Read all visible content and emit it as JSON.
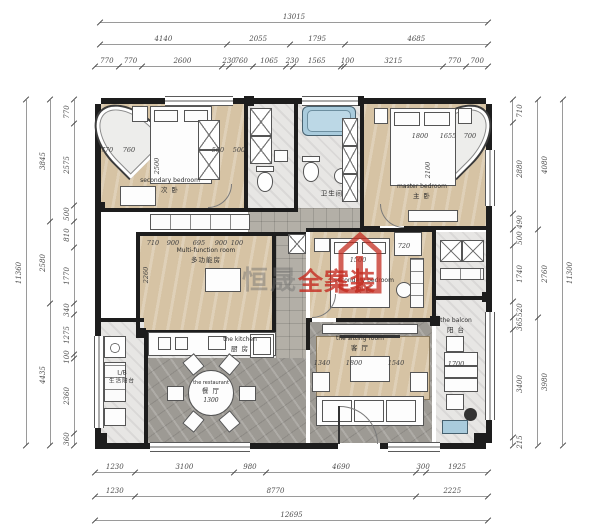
{
  "watermark": {
    "gray_text": "恒晟",
    "red_text": "全案装",
    "red_color": "#c42c20"
  },
  "rooms": {
    "secondary_bedroom": {
      "en": "secondary bedroom",
      "zh": "次 卧"
    },
    "master_bedroom": {
      "en": "master bedroom",
      "zh": "主 卧"
    },
    "multi_function_room": {
      "en": "Multi-function room",
      "zh": "多功能房"
    },
    "secondary_bedroom_2": {
      "en": "secondary bedroom",
      "zh": "次 卧"
    },
    "bathroom": {
      "en": "washroom",
      "zh": "卫生间"
    },
    "kitchen": {
      "en": "the kitchen",
      "zh": "厨 房"
    },
    "restaurant": {
      "en": "the restaurant",
      "zh": "餐 厅",
      "table_dim": "1300"
    },
    "sitting_room": {
      "en": "the sitting room",
      "zh": "客 厅"
    },
    "life_balcony": {
      "en": "L/B",
      "zh": "生活阳台"
    },
    "leisure_balcony": {
      "en": "the balcon",
      "zh": "阳 台"
    }
  },
  "dimensions": {
    "top": {
      "row1": [
        "13015"
      ],
      "row2": [
        "4140",
        "2055",
        "1795",
        "4685"
      ],
      "row3": [
        "770",
        "770",
        "2600",
        "230",
        "760",
        "1065",
        "230",
        "1565",
        "100",
        "3215",
        "770",
        "700"
      ]
    },
    "bottom": {
      "row1": [
        "1230",
        "3100",
        "980",
        "4690",
        "300",
        "1925"
      ],
      "row2": [
        "1230",
        "8770",
        "2225"
      ],
      "row3": [
        "12695"
      ]
    },
    "left": {
      "outer": [
        "11360"
      ],
      "middle": [
        "3845",
        "2580",
        "4435"
      ],
      "inner": [
        "770",
        "2575",
        "500",
        "810",
        "1770",
        "340",
        "1275",
        "100",
        "2360",
        "360"
      ]
    },
    "right": {
      "inner": [
        "710",
        "2880",
        "490",
        "500",
        "1740",
        "520",
        "365",
        "3400",
        "215"
      ],
      "middle": [
        "4080",
        "2760",
        "3980"
      ],
      "outer": [
        "11300"
      ]
    }
  },
  "annotations": [
    {
      "t": "770",
      "x": 107,
      "y": 150
    },
    {
      "t": "760",
      "x": 129,
      "y": 150
    },
    {
      "t": "560",
      "x": 218,
      "y": 150
    },
    {
      "t": "500",
      "x": 239,
      "y": 150
    },
    {
      "t": "2500",
      "x": 157,
      "y": 166,
      "v": 1
    },
    {
      "t": "1800",
      "x": 420,
      "y": 136
    },
    {
      "t": "2100",
      "x": 428,
      "y": 170,
      "v": 1
    },
    {
      "t": "1655",
      "x": 448,
      "y": 136
    },
    {
      "t": "700",
      "x": 470,
      "y": 136
    },
    {
      "t": "710",
      "x": 153,
      "y": 243
    },
    {
      "t": "900",
      "x": 173,
      "y": 243
    },
    {
      "t": "695",
      "x": 199,
      "y": 243
    },
    {
      "t": "900",
      "x": 221,
      "y": 243
    },
    {
      "t": "100",
      "x": 237,
      "y": 243
    },
    {
      "t": "2260",
      "x": 146,
      "y": 275,
      "v": 1
    },
    {
      "t": "1500",
      "x": 358,
      "y": 260
    },
    {
      "t": "720",
      "x": 404,
      "y": 246
    },
    {
      "t": "1340",
      "x": 322,
      "y": 363
    },
    {
      "t": "1800",
      "x": 354,
      "y": 363
    },
    {
      "t": "1540",
      "x": 396,
      "y": 363
    },
    {
      "t": "1700",
      "x": 456,
      "y": 364
    }
  ]
}
